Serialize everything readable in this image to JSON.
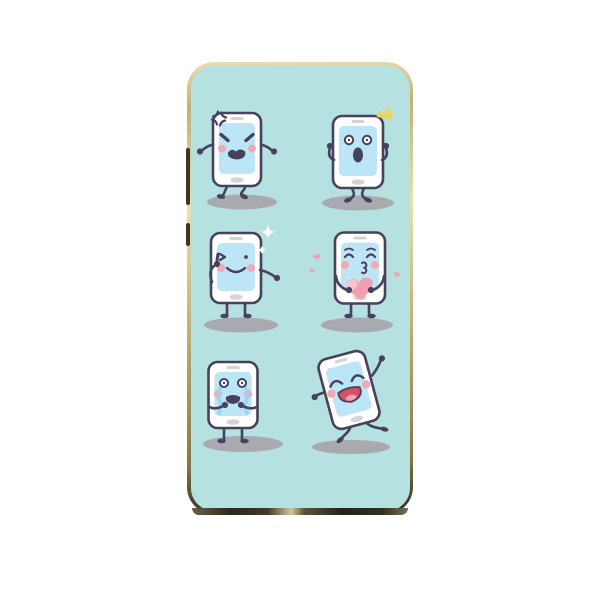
{
  "product": {
    "type": "phone-case",
    "design_theme": "cartoon smartphone emoji characters"
  },
  "colors": {
    "page_background": "#ffffff",
    "design_background": "#b5e1e0",
    "phone_body": "#ffffff",
    "outline": "#46415c",
    "screen": "#bce5f6",
    "bezel_detail": "#d3d4da",
    "cheek": "#f2a9b5",
    "shadow": "#a9a9b0",
    "heart_pink": "#f2a0af",
    "heart_highlight": "#f7c5ce",
    "mouth_red": "#d94f63",
    "tongue_pink": "#f2a2b1",
    "tear_blue": "#9dd3ee",
    "sparkle_yellow": "#edd35a",
    "sparkle_white": "#ffffff",
    "rim_gold_light": "#e9dfb4",
    "rim_gold": "#c0b173",
    "rim_gold_dark": "#857547",
    "rim_bottom_dark": "#2b281e",
    "side_button": "#393629"
  },
  "characters": [
    {
      "name": "angry-phone",
      "emotion": "angry",
      "cx": 46,
      "cy": 83.5,
      "w": 48,
      "h": 73,
      "rotate": 0,
      "shadow": {
        "cx": 51,
        "cy": 136,
        "rx": 35,
        "ry": 7.5
      },
      "decorations": [
        "anger-mark"
      ]
    },
    {
      "name": "surprised-phone",
      "emotion": "surprised",
      "cx": 167,
      "cy": 86,
      "w": 50,
      "h": 72,
      "rotate": 0,
      "shadow": {
        "cx": 167,
        "cy": 137,
        "rx": 36,
        "ry": 7.5
      },
      "decorations": [
        "crown-sparkle"
      ]
    },
    {
      "name": "wink-phone",
      "emotion": "wink",
      "cx": 45,
      "cy": 202,
      "w": 50,
      "h": 70,
      "rotate": 0,
      "shadow": {
        "cx": 50,
        "cy": 259,
        "rx": 37,
        "ry": 7.5
      },
      "decorations": [
        "white-sparkles"
      ]
    },
    {
      "name": "kiss-phone",
      "emotion": "kiss",
      "cx": 169,
      "cy": 202,
      "w": 50,
      "h": 71,
      "rotate": 0,
      "shadow": {
        "cx": 166,
        "cy": 259,
        "rx": 36,
        "ry": 7.5
      },
      "decorations": [
        "big-heart",
        "floating-hearts"
      ]
    },
    {
      "name": "cry-phone",
      "emotion": "cry",
      "cx": 42,
      "cy": 329,
      "w": 49,
      "h": 66,
      "rotate": 0,
      "shadow": {
        "cx": 52,
        "cy": 378,
        "rx": 40,
        "ry": 8
      },
      "decorations": []
    },
    {
      "name": "laugh-phone",
      "emotion": "laugh",
      "cx": 158,
      "cy": 324,
      "w": 48,
      "h": 72,
      "rotate": -15,
      "shadow": {
        "cx": 160,
        "cy": 381,
        "rx": 39,
        "ry": 7
      },
      "decorations": []
    }
  ]
}
